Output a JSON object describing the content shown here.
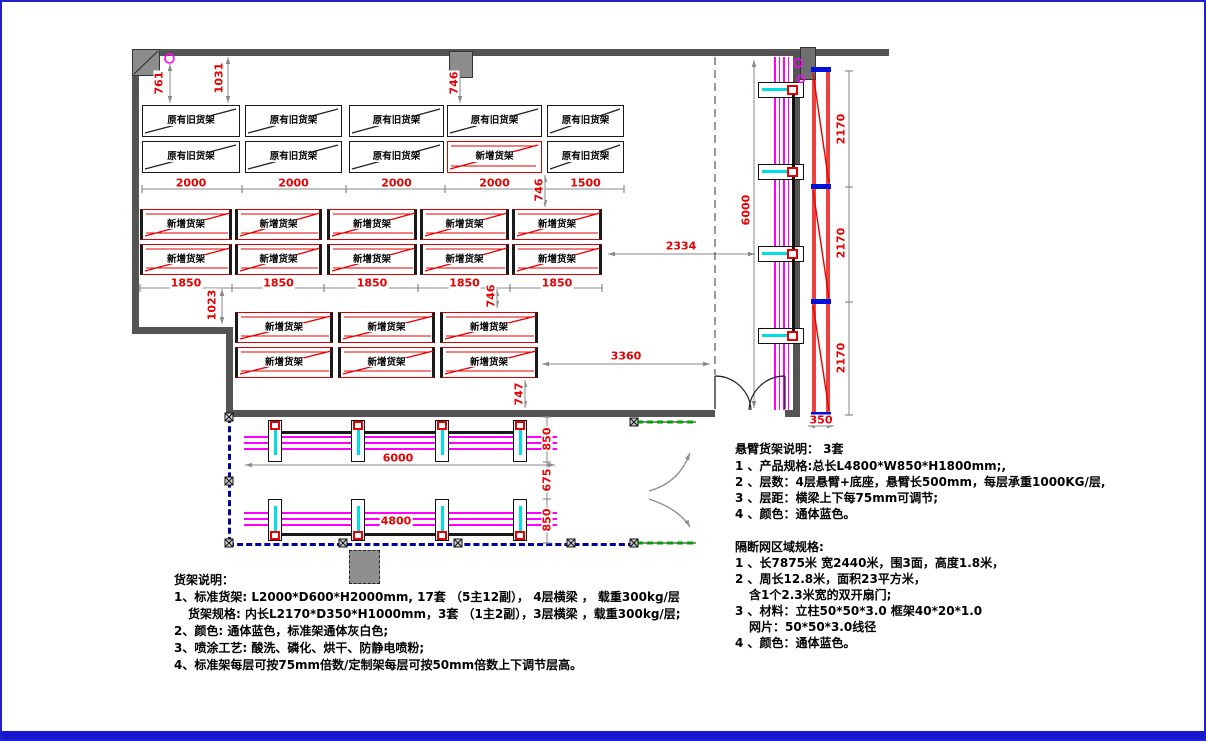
{
  "drawing": {
    "type": "warehouse-rack-layout-plan"
  },
  "colors": {
    "dim_text": "#e80000",
    "wall": "#545454",
    "magenta": "#ff00ff",
    "cyan": "#00dde6",
    "fence_blue": "#0000a0",
    "door_green": "#00a400",
    "strip_red": "#ef4040",
    "cap_blue": "#0011dd",
    "frame_blue": "#2020cc",
    "rack_new_red": "#e60000",
    "dim_line_gray": "#8a8a8a"
  },
  "rack_labels": {
    "old": "原有旧货架",
    "new": "新增货架"
  },
  "groups": {
    "g1": {
      "rows": [
        [
          "old",
          "old",
          "old",
          "old",
          "old"
        ],
        [
          "old",
          "old",
          "old",
          "new",
          "old"
        ]
      ]
    },
    "g2": {
      "rows": [
        [
          "new",
          "new",
          "new",
          "new",
          "new"
        ],
        [
          "new",
          "new",
          "new",
          "new",
          "new"
        ]
      ]
    },
    "g3": {
      "rows": [
        [
          "new",
          "new",
          "new"
        ],
        [
          "new",
          "new",
          "new"
        ]
      ]
    }
  },
  "dims": {
    "g1_widths": [
      "2000",
      "2000",
      "2000",
      "2000",
      "1500"
    ],
    "g2_widths": [
      "1850",
      "1850",
      "1850",
      "1850",
      "1850"
    ],
    "v_761": "761",
    "v_1031": "1031",
    "v_746_top": "746",
    "v_746_g1": "746",
    "v_1023": "1023",
    "v_746_g2": "746",
    "v_747": "747",
    "h_2334": "2334",
    "h_3360": "3360",
    "h_350": "350",
    "right_6000": "6000",
    "right_2170": [
      "2170",
      "2170",
      "2170"
    ],
    "cant_6000": "6000",
    "cant_4800": "4800",
    "cant_850_top": "850",
    "cant_675": "675",
    "cant_850_bottom": "850"
  },
  "notes_rack": {
    "title": "货架说明：",
    "lines": [
      "1、标准货架: L2000*D600*H2000mm, 17套 （5主12副），  4层横梁 ， 载重300kg/层",
      "货架规格: 内长L2170*D350*H1000mm，3套 （1主2副），3层横梁 ，载重300kg/层;",
      "2、颜色: 通体蓝色，标准架通体灰白色;",
      "3、喷涂工艺: 酸洗、磷化、烘干、防静电喷粉;",
      "4、标准架每层可按75mm倍数/定制架每层可按50mm倍数上下调节层高。"
    ]
  },
  "notes_cantilever": {
    "title": "悬臂货架说明：  3套",
    "lines": [
      "1 、产品规格:总长L4800*W850*H1800mm;,",
      "2 、层数：4层悬臂+底座，悬臂长500mm，每层承重1000KG/层,",
      "3 、层距：横梁上下每75mm可调节;",
      "4 、颜色：通体蓝色。"
    ]
  },
  "notes_fence": {
    "title": "隔断网区域规格:",
    "lines": [
      "1 、长7875米 宽2440米，围3面，高度1.8米，",
      "2 、周长12.8米，面积23平方米，",
      "含1个2.3米宽的双开扇门;",
      "3 、材料：立柱50*50*3.0  框架40*20*1.0",
      "网片：50*50*3.0线径",
      "4 、颜色：通体蓝色。"
    ]
  }
}
